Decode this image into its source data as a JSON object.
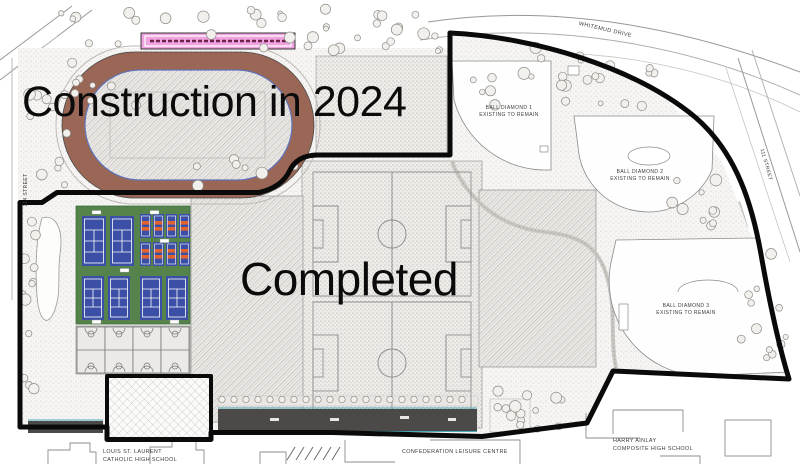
{
  "page": {
    "zone1_label": "Construction in 2024",
    "zone2_label": "Completed"
  },
  "roads": {
    "whitemud": "WHITEMUD DRIVE",
    "street_111": "111 STREET",
    "street_114": "114 STREET"
  },
  "facilities": {
    "ball_diamond_1": {
      "line1": "BALL DIAMOND 1",
      "line2": "EXISTING TO REMAIN"
    },
    "ball_diamond_2": {
      "line1": "BALL DIAMOND 2",
      "line2": "EXISTING TO REMAIN"
    },
    "ball_diamond_3": {
      "line1": "BALL DIAMOND 3",
      "line2": "EXISTING TO REMAIN"
    }
  },
  "landmarks": {
    "louis_line1": "LOUIS ST. LAURENT",
    "louis_line2": "CATHOLIC HIGH SCHOOL",
    "confederation": "CONFEDERATION LEISURE CENTRE",
    "harry_line1": "HARRY AINLAY",
    "harry_line2": "COMPOSITE HIGH SCHOOL"
  },
  "colors": {
    "track_brown": "#9a6756",
    "track_inner_line": "#5f74b8",
    "tennis_green": "#55834b",
    "court_blue": "#3a4fa5",
    "pickleball_orange": "#e0622f",
    "pink_strip": "#efa4e0",
    "parking_dark": "#4b4a49",
    "teal_edge": "#4aa8b8",
    "boundary_black": "#0a0a0a"
  }
}
